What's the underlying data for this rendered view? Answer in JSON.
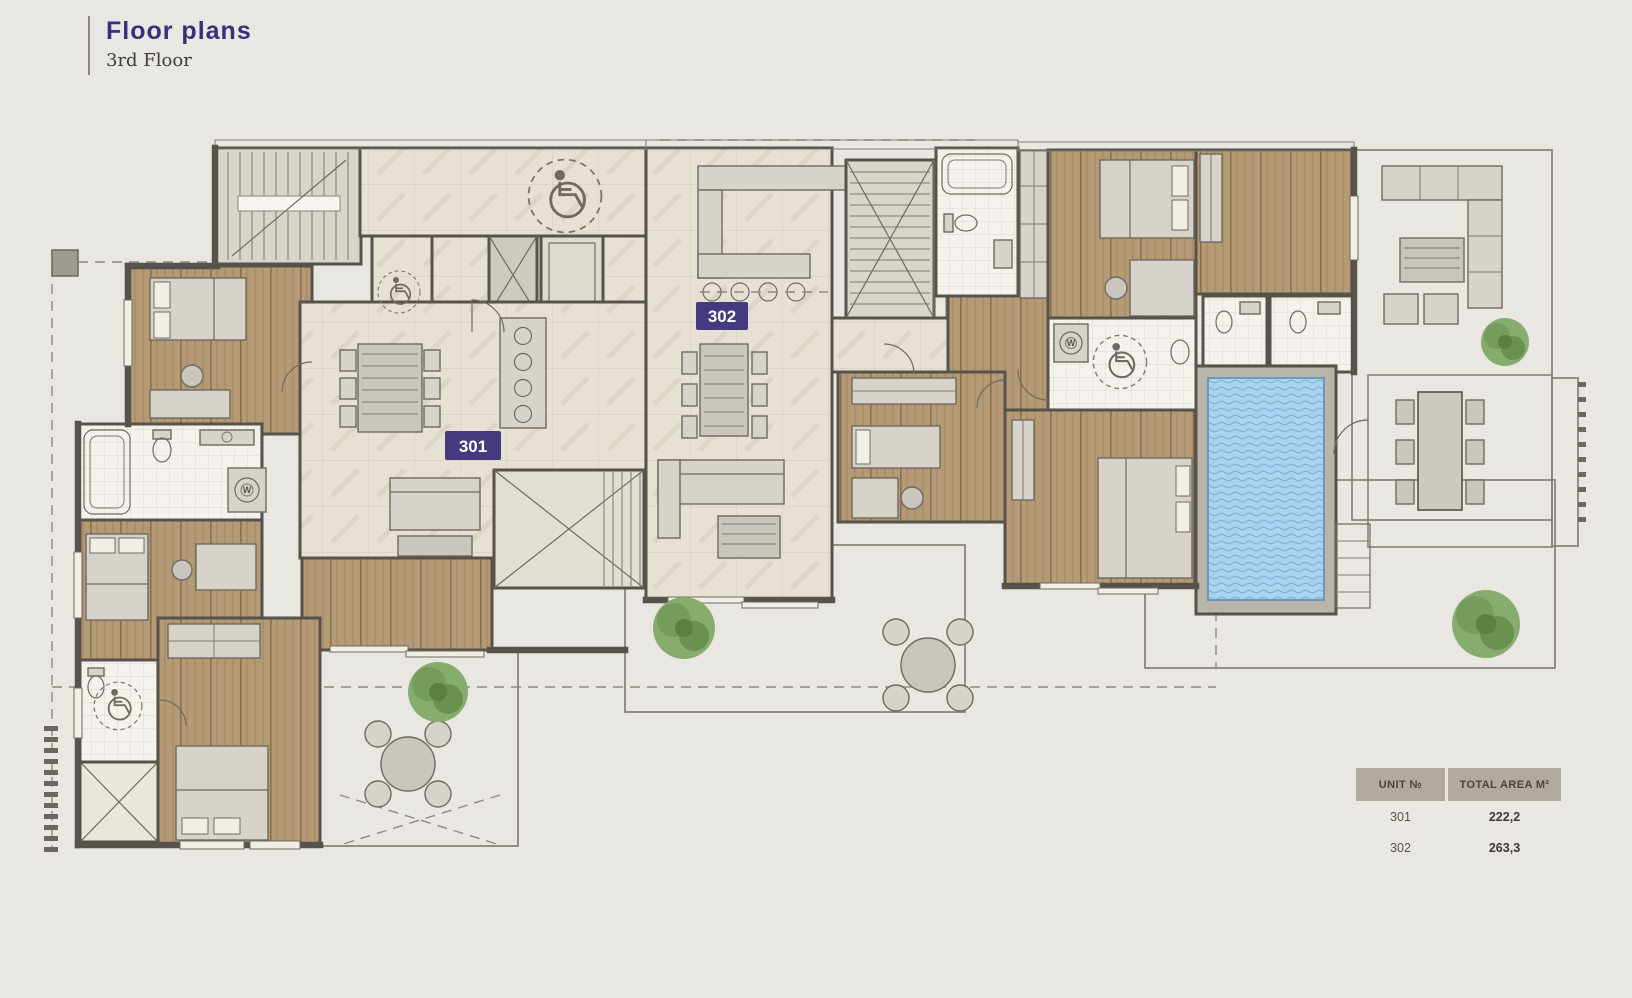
{
  "header": {
    "title": "Floor plans",
    "subtitle": "3rd Floor"
  },
  "plan": {
    "unit_badges": [
      {
        "label": "301"
      },
      {
        "label": "302"
      }
    ],
    "washer_label": "W"
  },
  "legend_table": {
    "headers": [
      "UNIT №",
      "TOTAL AREA M²"
    ],
    "rows": [
      {
        "unit": "301",
        "area": "222,2"
      },
      {
        "unit": "302",
        "area": "263,3"
      }
    ]
  },
  "units": [
    {
      "id": "301",
      "total_area_m2": "222,2"
    },
    {
      "id": "302",
      "total_area_m2": "263,3"
    }
  ],
  "icons": {
    "accessibility": "wheelchair-icon",
    "appliance": "washer-icon",
    "landscape": "tree-icon"
  },
  "colors": {
    "background": "#e9e7e2",
    "accent_purple": "#3b2f7a",
    "unit_badge_bg": "#453a7f",
    "wall": "#57524b",
    "wood_floor": "#b59b75",
    "tile_floor": "#e7e1d3",
    "terrace_tile": "#c8c4bb",
    "bathroom_tile": "#f4f2ed",
    "pool_water": "#a9d3ee",
    "tree_green": "#6fa057",
    "table_header_bg": "#b2aa9c"
  }
}
